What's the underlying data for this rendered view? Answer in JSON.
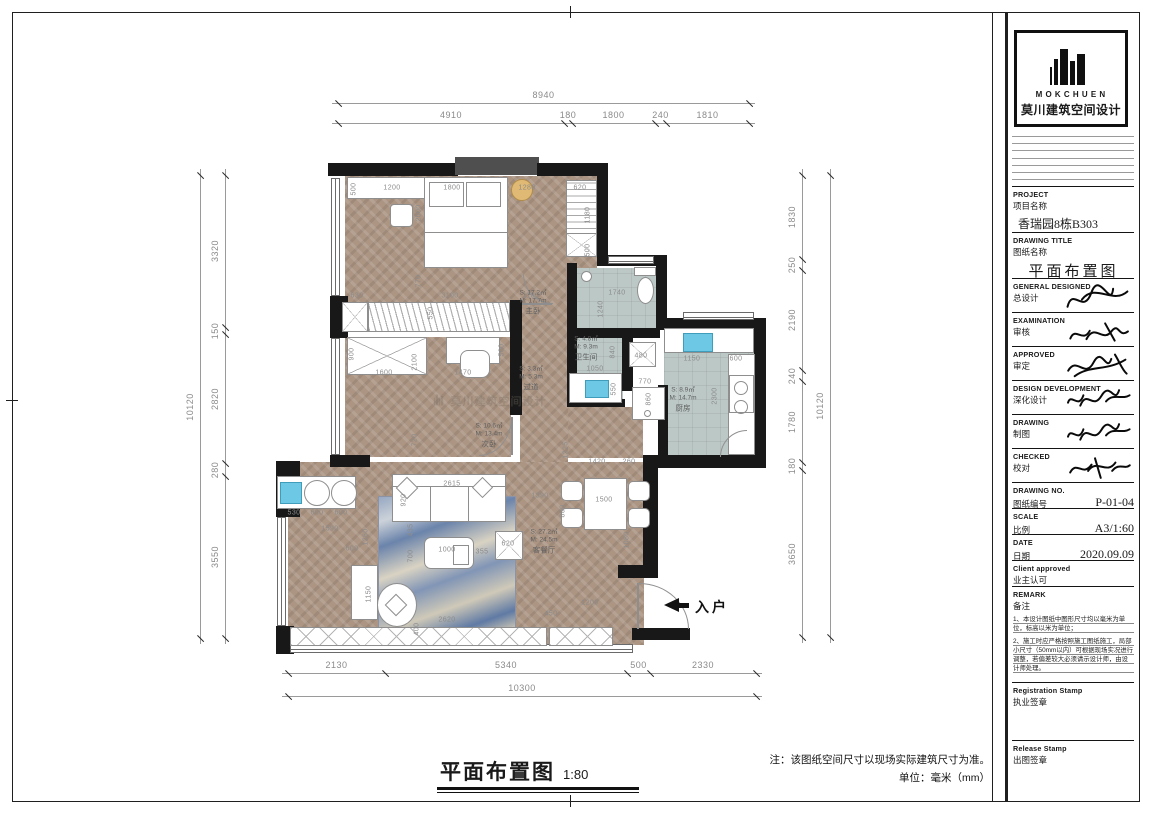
{
  "page": {
    "footer_title": "平面布置图",
    "footer_scale": "1:80",
    "footer_note1": "注：该图纸空间尺寸以现场实际建筑尺寸为准。",
    "footer_note2": "单位：毫米（mm）",
    "entry_label": "入户"
  },
  "logo": {
    "name_en": "MOKCHUEN",
    "name_cn": "莫川建筑空间设计"
  },
  "watermark": {
    "cn": "莫川建筑空间设计"
  },
  "colors": {
    "wall": "#181818",
    "wood": "#ac9583",
    "tile": "#bcc8c6",
    "sink": "#6cc8e4",
    "dim_text": "#8a8a8a"
  },
  "title_block": {
    "sections": [
      {
        "en": "PROJECT",
        "cn": "项目名称",
        "value": "香瑞园8栋B303",
        "kind": "value",
        "h": 46
      },
      {
        "en": "DRAWING TITLE",
        "cn": "图纸名称",
        "value": "平面布置图",
        "kind": "big",
        "h": 46
      },
      {
        "en": "GENERAL  DESIGNED",
        "cn": "总设计",
        "kind": "signature",
        "sig": 0,
        "h": 34
      },
      {
        "en": "EXAMINATION",
        "cn": "审核",
        "kind": "signature",
        "sig": 1,
        "h": 34
      },
      {
        "en": "APPROVED",
        "cn": "审定",
        "kind": "signature",
        "sig": 2,
        "h": 34
      },
      {
        "en": "DESIGN DEVELOPMENT",
        "cn": "深化设计",
        "kind": "signature",
        "sig": 3,
        "h": 34
      },
      {
        "en": "DRAWING",
        "cn": "制图",
        "kind": "signature",
        "sig": 3,
        "h": 34
      },
      {
        "en": "CHECKED",
        "cn": "校对",
        "kind": "signature",
        "sig": 4,
        "h": 34
      },
      {
        "en": "DRAWING NO.",
        "cn": "图纸编号",
        "value": "P-01-04",
        "kind": "row",
        "h": 26
      },
      {
        "en": "SCALE",
        "cn": "比例",
        "value": "A3/1:60",
        "kind": "row",
        "h": 26
      },
      {
        "en": "DATE",
        "cn": "日期",
        "value": "2020.09.09",
        "kind": "row",
        "h": 26
      },
      {
        "en": "Client approved",
        "cn": "业主认可",
        "kind": "blank",
        "h": 26
      },
      {
        "en": "REMARK",
        "cn": "备注",
        "kind": "remark",
        "h": 96,
        "notes": [
          "1、本设计图纸中图形尺寸均以毫米为单位，标高以米为单位；",
          "2、施工时应严格按照施工图纸施工，局部小尺寸（50mm以内）可根据现场实况进行调整，若偏差较大必须请示设计师，由设计师处理。"
        ]
      },
      {
        "en": "Registration Stamp",
        "cn": "执业签章",
        "kind": "stamp",
        "h": 58
      },
      {
        "en": "Release Stamp",
        "cn": "出图签章",
        "kind": "stamp",
        "h": 50
      }
    ]
  },
  "dimensions": {
    "top_total": {
      "dir": "h",
      "line": 103,
      "ticks": [
        338,
        749
      ],
      "labels": [
        "8940"
      ]
    },
    "top_segs": {
      "dir": "h",
      "line": 123,
      "ticks": [
        338,
        564,
        572,
        655,
        666,
        749
      ],
      "labels": [
        "4910",
        "180",
        "1800",
        "240",
        "1810"
      ]
    },
    "bottom_segs": {
      "dir": "h",
      "line": 673,
      "ticks": [
        288,
        385,
        627,
        650,
        756
      ],
      "labels": [
        "2130",
        "5340",
        "500",
        "2330"
      ]
    },
    "bottom_total": {
      "dir": "h",
      "line": 696,
      "ticks": [
        288,
        756
      ],
      "labels": [
        "10300"
      ]
    },
    "left_total": {
      "dir": "v",
      "line": 200,
      "ticks": [
        175,
        638
      ],
      "labels": [
        "10120"
      ]
    },
    "left_segs": {
      "dir": "v",
      "line": 225,
      "ticks": [
        175,
        327,
        334,
        463,
        476,
        638
      ],
      "labels": [
        "3320",
        "150",
        "2820",
        "280",
        "3550"
      ]
    },
    "right_segs": {
      "dir": "v",
      "line": 802,
      "ticks": [
        175,
        259,
        270,
        370,
        381,
        462,
        470,
        637
      ],
      "labels": [
        "1830",
        "250",
        "2190",
        "240",
        "1780",
        "180",
        "3650"
      ]
    },
    "right_total": {
      "dir": "v",
      "line": 830,
      "ticks": [
        175,
        637
      ],
      "labels": [
        "10120"
      ]
    }
  },
  "rooms": [
    {
      "s": "S: 17.2㎡",
      "m": "M: 17.7m",
      "n": "主卧",
      "x": 533,
      "y": 303
    },
    {
      "s": "S: 10.6㎡",
      "m": "M: 13.4m",
      "n": "次卧",
      "x": 489,
      "y": 436
    },
    {
      "s": "S: 3.3㎡",
      "m": "M: 5.3m",
      "n": "过道",
      "x": 531,
      "y": 379
    },
    {
      "s": "S: 4.8㎡",
      "m": "M: 9.3m",
      "n": "卫生间",
      "x": 586,
      "y": 349
    },
    {
      "s": "S: 8.9㎡",
      "m": "M: 14.7m",
      "n": "厨房",
      "x": 683,
      "y": 400
    },
    {
      "s": "S: 27.2㎡",
      "m": "M: 24.5m",
      "n": "客餐厅",
      "x": 544,
      "y": 542
    }
  ],
  "annotations": [
    {
      "t": "500",
      "x": 354,
      "y": 189,
      "v": 1
    },
    {
      "t": "1200",
      "x": 392,
      "y": 188
    },
    {
      "t": "1800",
      "x": 452,
      "y": 188
    },
    {
      "t": "1280",
      "x": 527,
      "y": 188
    },
    {
      "t": "620",
      "x": 580,
      "y": 188
    },
    {
      "t": "2000",
      "x": 419,
      "y": 213,
      "v": 1
    },
    {
      "t": "770",
      "x": 419,
      "y": 281,
      "v": 1
    },
    {
      "t": "630",
      "x": 357,
      "y": 296
    },
    {
      "t": "3100",
      "x": 450,
      "y": 296
    },
    {
      "t": "1180",
      "x": 531,
      "y": 296
    },
    {
      "t": "550",
      "x": 431,
      "y": 313,
      "v": 1
    },
    {
      "t": "1180",
      "x": 588,
      "y": 215,
      "v": 1
    },
    {
      "t": "500",
      "x": 588,
      "y": 250,
      "v": 1
    },
    {
      "t": "1740",
      "x": 617,
      "y": 293
    },
    {
      "t": "1240",
      "x": 601,
      "y": 309,
      "v": 1
    },
    {
      "t": "840",
      "x": 613,
      "y": 352,
      "v": 1
    },
    {
      "t": "1050",
      "x": 595,
      "y": 369
    },
    {
      "t": "480",
      "x": 641,
      "y": 356
    },
    {
      "t": "550",
      "x": 614,
      "y": 389,
      "v": 1
    },
    {
      "t": "770",
      "x": 645,
      "y": 382
    },
    {
      "t": "860",
      "x": 649,
      "y": 399,
      "v": 1
    },
    {
      "t": "1150",
      "x": 692,
      "y": 359
    },
    {
      "t": "600",
      "x": 736,
      "y": 359
    },
    {
      "t": "2300",
      "x": 715,
      "y": 396,
      "v": 1
    },
    {
      "t": "1420",
      "x": 597,
      "y": 462
    },
    {
      "t": "260",
      "x": 629,
      "y": 462
    },
    {
      "t": "900",
      "x": 352,
      "y": 354,
      "v": 1
    },
    {
      "t": "1600",
      "x": 384,
      "y": 373
    },
    {
      "t": "2100",
      "x": 415,
      "y": 362,
      "v": 1
    },
    {
      "t": "1470",
      "x": 463,
      "y": 373
    },
    {
      "t": "500",
      "x": 502,
      "y": 350,
      "v": 1
    },
    {
      "t": "720",
      "x": 415,
      "y": 440,
      "v": 1
    },
    {
      "t": "1225",
      "x": 566,
      "y": 450,
      "v": 1
    },
    {
      "t": "1390",
      "x": 540,
      "y": 496
    },
    {
      "t": "800",
      "x": 563,
      "y": 511,
      "v": 1
    },
    {
      "t": "1500",
      "x": 604,
      "y": 500
    },
    {
      "t": "1080",
      "x": 627,
      "y": 540,
      "v": 1
    },
    {
      "t": "1200",
      "x": 590,
      "y": 603
    },
    {
      "t": "450",
      "x": 551,
      "y": 614
    },
    {
      "t": "2615",
      "x": 452,
      "y": 484
    },
    {
      "t": "920",
      "x": 404,
      "y": 500,
      "v": 1
    },
    {
      "t": "435",
      "x": 411,
      "y": 530,
      "v": 1
    },
    {
      "t": "700",
      "x": 411,
      "y": 556,
      "v": 1
    },
    {
      "t": "1000",
      "x": 447,
      "y": 550
    },
    {
      "t": "355",
      "x": 482,
      "y": 552
    },
    {
      "t": "620",
      "x": 508,
      "y": 544
    },
    {
      "t": "2620",
      "x": 447,
      "y": 620
    },
    {
      "t": "400",
      "x": 417,
      "y": 629,
      "v": 1
    },
    {
      "t": "1260",
      "x": 366,
      "y": 537,
      "v": 1
    },
    {
      "t": "1590",
      "x": 330,
      "y": 529
    },
    {
      "t": "600",
      "x": 352,
      "y": 549
    },
    {
      "t": "1150",
      "x": 369,
      "y": 594,
      "v": 1
    },
    {
      "t": "530",
      "x": 294,
      "y": 513
    },
    {
      "t": "600",
      "x": 317,
      "y": 513
    },
    {
      "t": "600",
      "x": 341,
      "y": 513
    }
  ]
}
